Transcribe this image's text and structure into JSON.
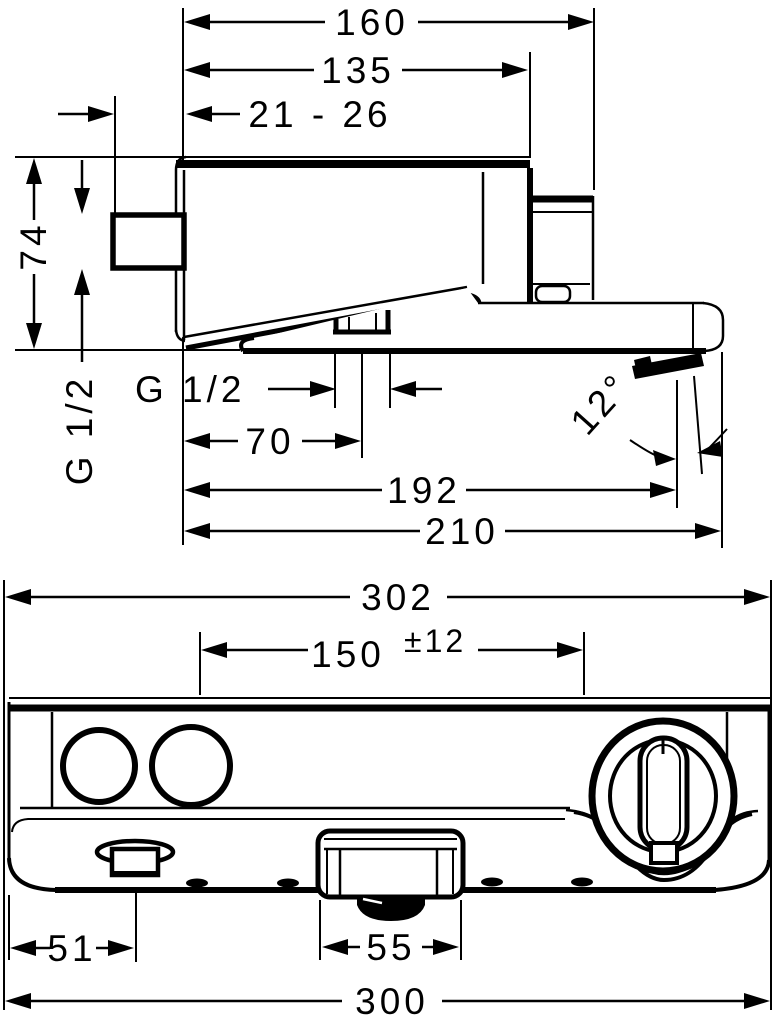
{
  "colors": {
    "ink": "#000000",
    "paper": "#ffffff"
  },
  "side_view": {
    "dims": {
      "overall_depth": "160",
      "body_depth": "135",
      "adjust_range": "21 - 26",
      "height": "74",
      "inlet_thread": "G 1/2",
      "hose_outlet_thread": "G 1/2",
      "hose_outlet_offset": "70",
      "aerator_reach": "192",
      "spout_reach": "210",
      "spray_angle": "12°"
    }
  },
  "front_view": {
    "dims": {
      "overall_width": "302",
      "hose_centers": "150",
      "hose_centers_tolerance": "±12",
      "diverter_offset": "51",
      "spout_width": "55",
      "body_width": "300"
    }
  }
}
